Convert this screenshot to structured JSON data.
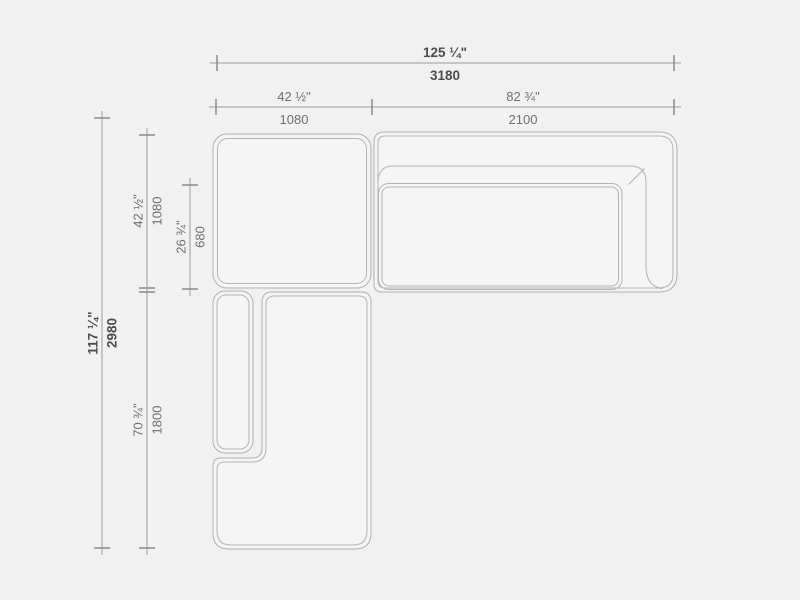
{
  "drawing": {
    "kind": "sectional-sofa-top-view-dimension-plan",
    "units": [
      "inches",
      "millimeters"
    ]
  },
  "colors": {
    "background": "#f1f1f2",
    "furniture_line": "#b3b3b3",
    "furniture_fill": "#f5f5f6",
    "dimension_line": "#9b9b9b",
    "label_regular": "#6f6f6f",
    "label_strong": "#4d4d4d"
  },
  "dimensions": {
    "overall_width": {
      "inches": "125 ¼\"",
      "mm": "3180"
    },
    "left_front_width": {
      "inches": "42 ½\"",
      "mm": "1080"
    },
    "right_front_width": {
      "inches": "82 ¾\"",
      "mm": "2100"
    },
    "overall_depth": {
      "inches": "117 ¼\"",
      "mm": "2980"
    },
    "top_module_depth": {
      "inches": "42 ½\"",
      "mm": "1080"
    },
    "seat_depth": {
      "inches": "26 ¾\"",
      "mm": "680"
    },
    "chaise_length": {
      "inches": "70 ¾\"",
      "mm": "1800"
    }
  }
}
